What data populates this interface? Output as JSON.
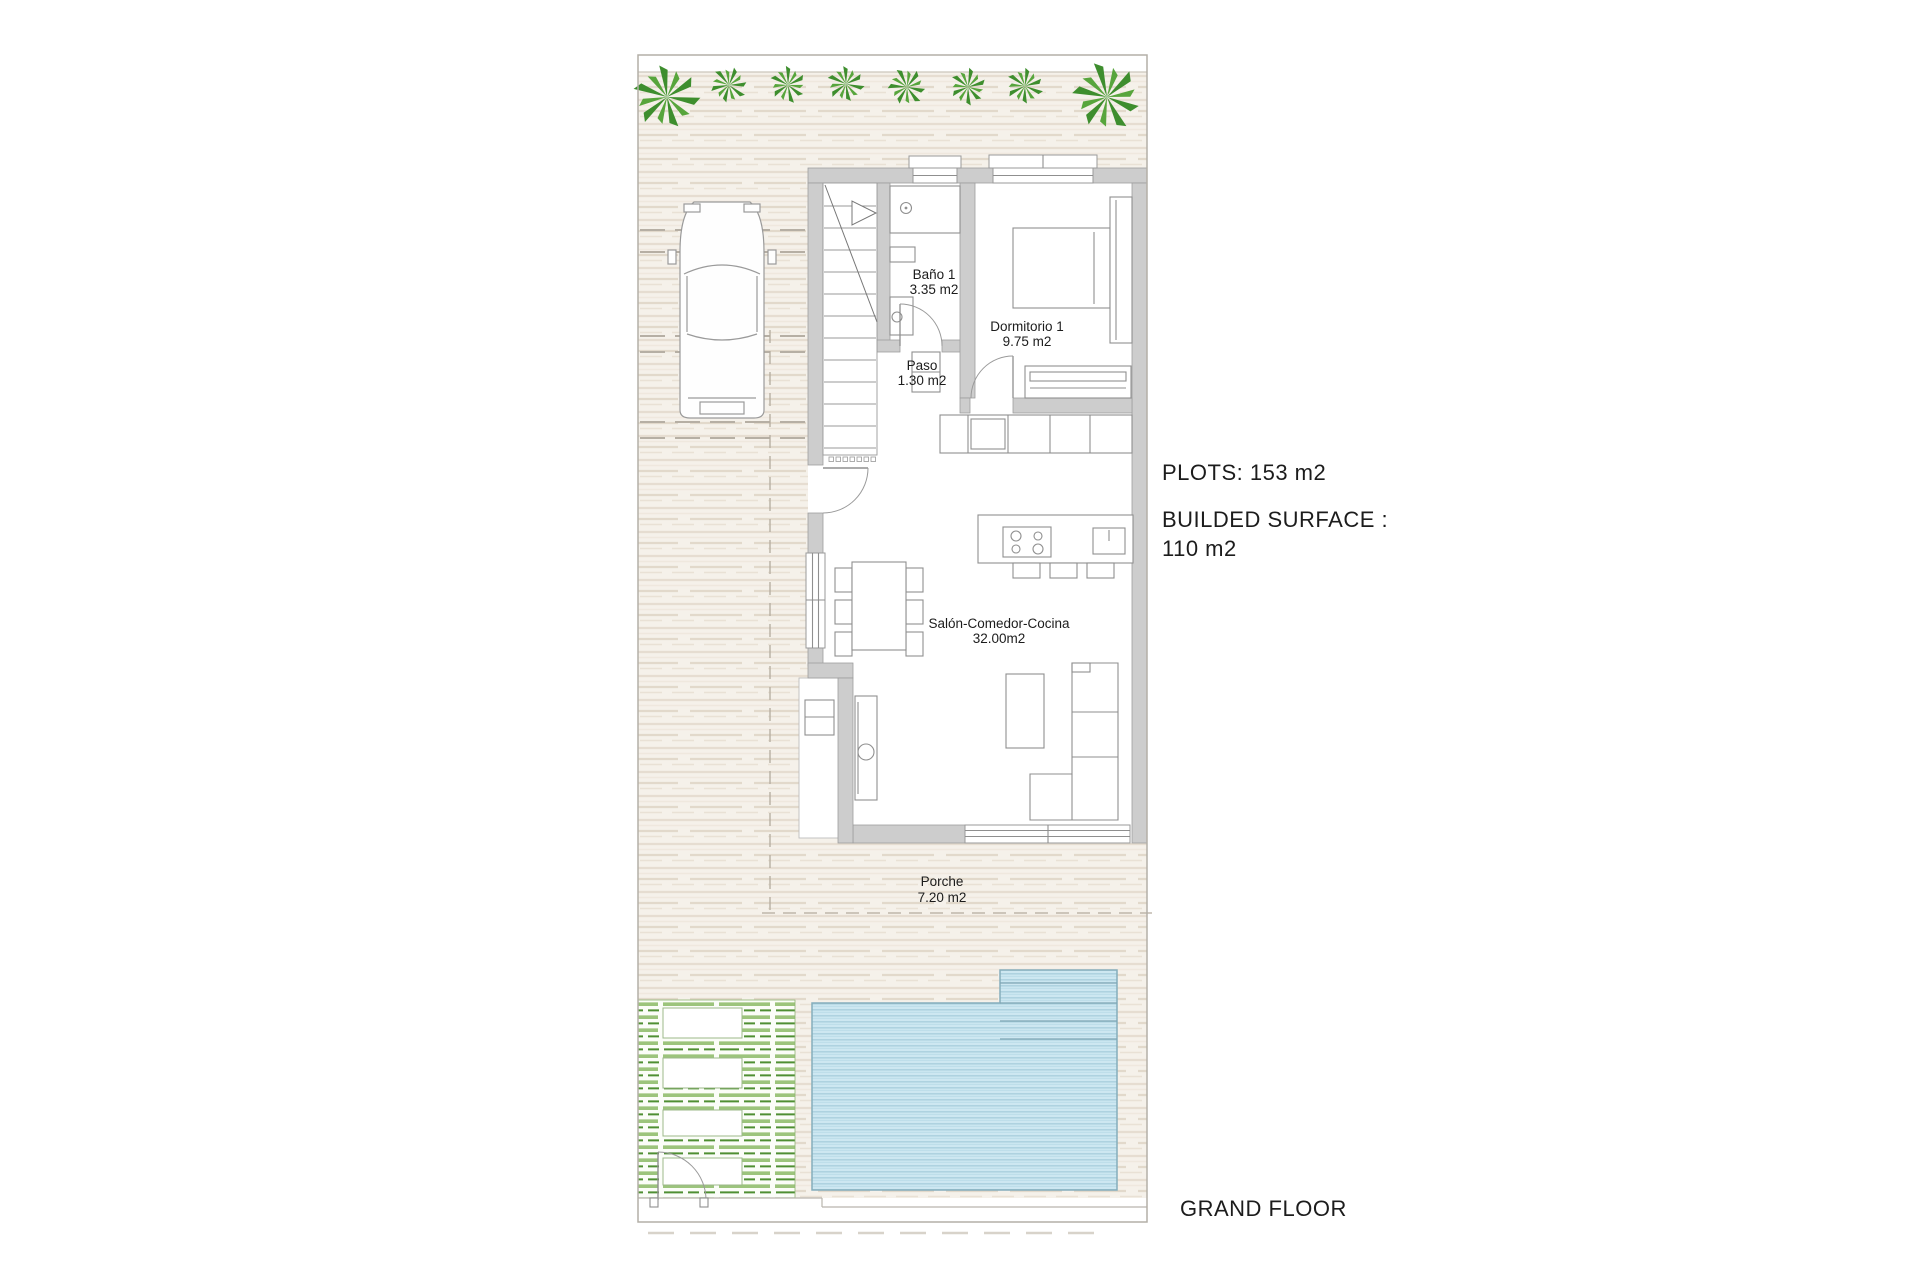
{
  "title": "Villa ground floor plan",
  "rooms": [
    {
      "name": "Baño 1",
      "area": "3.35 m2"
    },
    {
      "name": "Dormitorio 1",
      "area": "9.75 m2"
    },
    {
      "name": "Paso",
      "area": "1.30 m2"
    },
    {
      "name": "Salón-Comedor-Cocina",
      "area": "32.00m2"
    },
    {
      "name": "Porche",
      "area": "7.20 m2"
    }
  ],
  "annotations": {
    "plots": "PLOTS: 153 m2",
    "built_surface_label": "BUILDED SURFACE :",
    "built_surface_value": "110 m2",
    "floor_label": "GRAND FLOOR"
  },
  "colors": {
    "background": "#ffffff",
    "terrace_stripe": "#e4dbce",
    "wall_grey": "#cdcdcd",
    "wall_edge": "#9e9e9e",
    "palm_green": "#3e8e2e",
    "palm_green_light": "#57a53c",
    "lawn_green": "#9cc47c",
    "lawn_green_dark": "#4f8f33",
    "pool_fill": "#cde7f1",
    "pool_stripe": "#a9cfdd",
    "pool_edge": "#85aebc",
    "drawing_line": "#8f8f8f",
    "text": "#1c1c1c"
  },
  "features": {
    "palm_count": 8,
    "elements": [
      "plot-boundary",
      "terrace-paving",
      "driveway",
      "car",
      "stairs",
      "pool",
      "lawn",
      "garden-gate",
      "entrance-door",
      "kitchen-island",
      "dining-table",
      "sofa",
      "bed"
    ]
  }
}
